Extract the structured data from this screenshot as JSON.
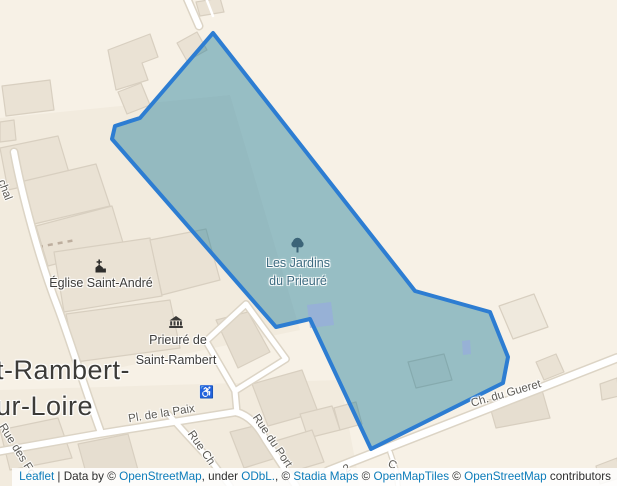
{
  "map": {
    "polygon": {
      "points": "213,33 415,291 490,312 508,357 503,383 371,449 310,319 276,327 112,139 115,126 140,118",
      "stroke": "#2d7dd2",
      "fill": "rgba(20,120,150,0.42)"
    },
    "poi": {
      "garden_line1": "Les Jardins",
      "garden_line2": "du Prieuré",
      "church": "Église Saint-André",
      "priory_line1": "Prieuré de",
      "priory_line2": "Saint-Rambert",
      "city_line1": "t-Rambert-",
      "city_line2": "ur-Loire",
      "tree_icon": "tree",
      "church_icon": "church",
      "museum_icon": "museum",
      "wheelchair_icon": "♿"
    },
    "streets": {
      "marechal": "chal",
      "paix": "Pl. de la Paix",
      "port": "Rue du Port",
      "rue_ch": "Rue Ch",
      "gueret": "Ch. du Gueret",
      "rue_des_fo": "Rue des Fo",
      "frag_2": "2",
      "frag_c": "C"
    },
    "colors": {
      "background": "#f7f1e6",
      "building_fill": "#eae2d4",
      "building_stroke": "#d8cfc0",
      "road_fill": "#ffffff",
      "road_casing": "#dcd4c5",
      "tinted_building": "rgba(150,170,225,0.65)"
    }
  },
  "attribution": {
    "segments": [
      {
        "text": "Leaflet",
        "link": true
      },
      {
        "text": " | Data by © ",
        "link": false
      },
      {
        "text": "OpenStreetMap",
        "link": true
      },
      {
        "text": ", under ",
        "link": false
      },
      {
        "text": "ODbL.",
        "link": true
      },
      {
        "text": ", © ",
        "link": false
      },
      {
        "text": "Stadia Maps",
        "link": true
      },
      {
        "text": " © ",
        "link": false
      },
      {
        "text": "OpenMapTiles",
        "link": true
      },
      {
        "text": " © ",
        "link": false
      },
      {
        "text": "OpenStreetMap",
        "link": true
      },
      {
        "text": " contributors",
        "link": false
      }
    ]
  }
}
